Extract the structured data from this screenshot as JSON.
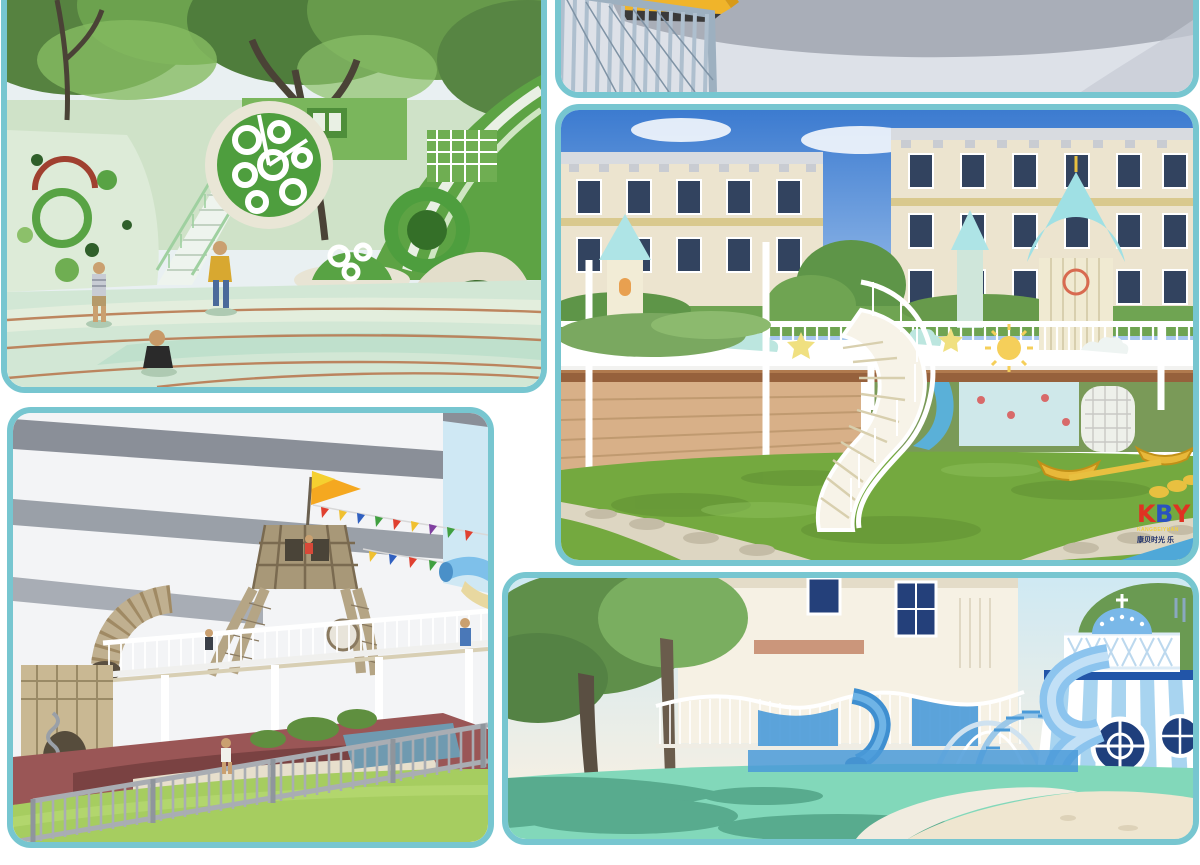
{
  "page": {
    "background_color": "#ffffff",
    "frame_color": "#77c6d0",
    "layout": "five rounded-corner playground renderings in a collage, edges cropped at top/left/right"
  },
  "panels": [
    {
      "id": "green-forest-playground",
      "position": "top-left",
      "description": "Rendering of a green forest playground: large trees over pale-green terrain, climbing wall with circular cutouts, big perforated wheel feature, green staircases, ring arches, cream tunnel dome, curved running tracks, three small children playing"
    },
    {
      "id": "plaza-strip",
      "position": "top-right-strip",
      "description": "Cropped strip of a rendering: pale blue-grey vertical-bar railing with a yellow slide behind it on a grey concrete plaza"
    },
    {
      "id": "courtyard-castle-playground",
      "position": "middle-right",
      "description": "Courtyard kindergarten playground: cream apartment blocks with dark windows under blue sky, elevated white railing deck with turquoise castle towers, cloud and star cutouts, white spiral staircase, wooden deck, yellow boat rockers on green lawn, stone path and blue water in the corner",
      "watermark": {
        "letters": [
          "K",
          "B",
          "Y"
        ],
        "letter_colors": [
          "#e03222",
          "#2a52c0",
          "#e03222"
        ],
        "line1": "KANGBEIYUAN",
        "line2": "康贝时光 乐"
      }
    },
    {
      "id": "ship-net-climber-playground",
      "position": "bottom-left",
      "description": "Playground beside a white building with grey bands: rope-net ship tower with yellow pennant flag and bunting, wooden tube slide, white elevated walkway, maroon safety ground, green lawn and grey picket fence in the foreground"
    },
    {
      "id": "santorini-blue-playground",
      "position": "bottom-right",
      "description": "Greek Santorini-style play area: blue-and-white striped tower with dome, porthole windows and spiral tube slide, wavy white railing walkway, arch climbers, trees casting shadows on mint-green surfacing with a white path and sand"
    }
  ],
  "palette": {
    "leaf_green": "#5f9348",
    "play_green": "#58a344",
    "pale_mint": "#d2e7d5",
    "sky_blue": "#4a86d8",
    "cream_building": "#ece4cf",
    "turquoise_roof": "#a2e2e6",
    "grass": "#74a93f",
    "deck_brown": "#96613c",
    "maroon_ground": "#9a5656",
    "lawn": "#a6cd60",
    "fence_grey": "#a9adb3",
    "slide_blue": "#8cc4ee",
    "navy_trim": "#2255a8",
    "mint_ground": "#82d8ba",
    "sand": "#efe6d0",
    "slide_yellow": "#f0b42a"
  }
}
